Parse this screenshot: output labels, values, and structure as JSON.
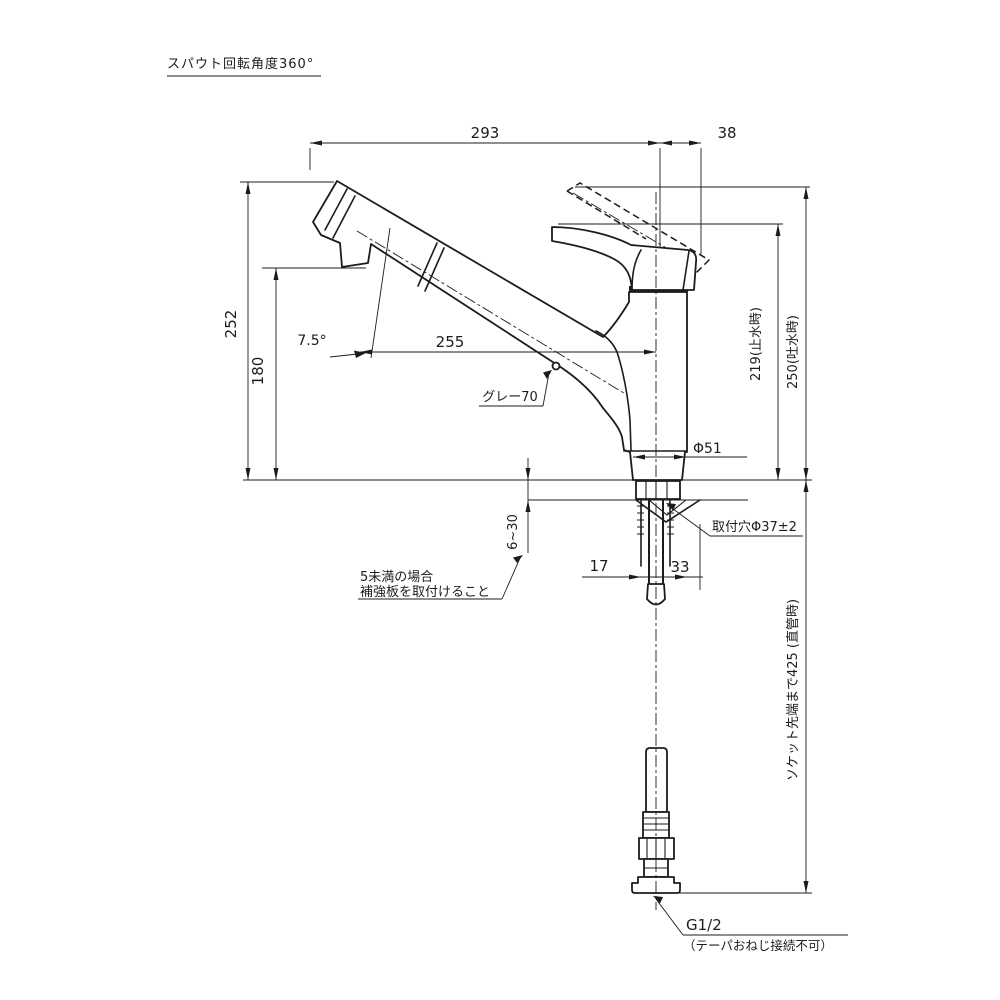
{
  "title": "スパウト回転角度360°",
  "dims": {
    "w293": "293",
    "w38": "38",
    "h252": "252",
    "h180": "180",
    "w255": "255",
    "angle": "7.5°",
    "gray": "グレー70",
    "h219": "219(止水時)",
    "h250": "250(吐水時)",
    "phi51": "Φ51",
    "hole": "取付穴Φ37±2",
    "deck": "6~30",
    "w17": "17",
    "w33": "33",
    "socket425": "ソケット先端まで425 (直管時)"
  },
  "notes": {
    "reinforce1": "5未満の場合",
    "reinforce2": "補強板を取付けること",
    "thread": "G1/2",
    "thread_note": "（テーパおねじ接続不可）"
  },
  "colors": {
    "line": "#1c1c1c",
    "background": "#ffffff"
  }
}
